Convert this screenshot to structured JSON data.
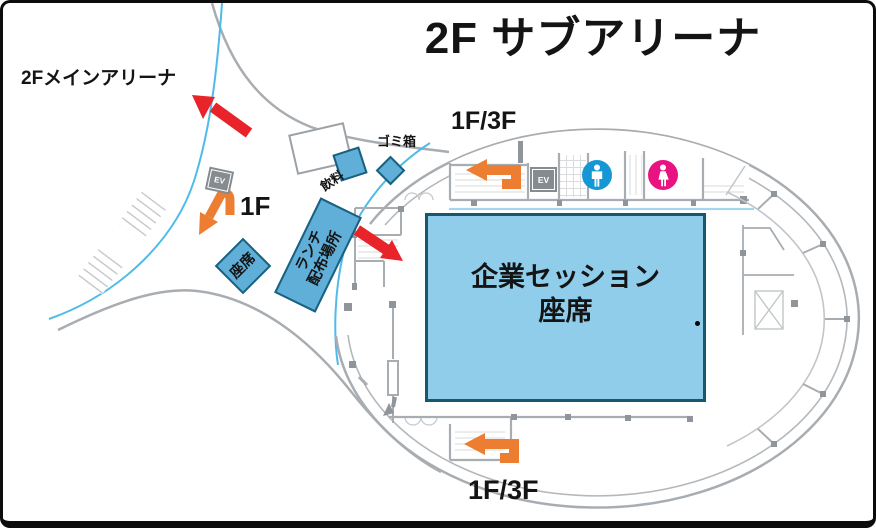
{
  "title": "2F サブアリーナ",
  "labels": {
    "main_arena_direction": "2Fメインアリーナ",
    "stairs_down_1f": "1F",
    "stairs_top_1f3f": "1F/3F",
    "stairs_bottom_1f3f": "1F/3F",
    "trash_bin": "ゴミ箱",
    "drinks": "飲料",
    "lunch_distribution": {
      "line1": "ランチ",
      "line2": "配布場所"
    },
    "small_seats": "座席",
    "session_seats": {
      "line1": "企業セッション",
      "line2": "座席"
    },
    "elevator": "EV"
  },
  "icons": {
    "mens_restroom": "man-silhouette-in-blue-circle",
    "womens_restroom": "woman-silhouette-in-pink-circle",
    "red_arrows": "direction-to-main-arena-and-entrance",
    "orange_arrows": "stair-direction-arrows"
  },
  "colors": {
    "orange": "#ED7D31",
    "red": "#E8232A",
    "box-fill": "#5FAFD8",
    "box-border": "#1A607F",
    "session-fill": "#8FCDEA",
    "session-border": "#19566F",
    "wall": "#A8ADB2",
    "glass": "#4FBBE9",
    "male": "#1697D5",
    "female": "#E81380",
    "ev": "#868B90"
  }
}
